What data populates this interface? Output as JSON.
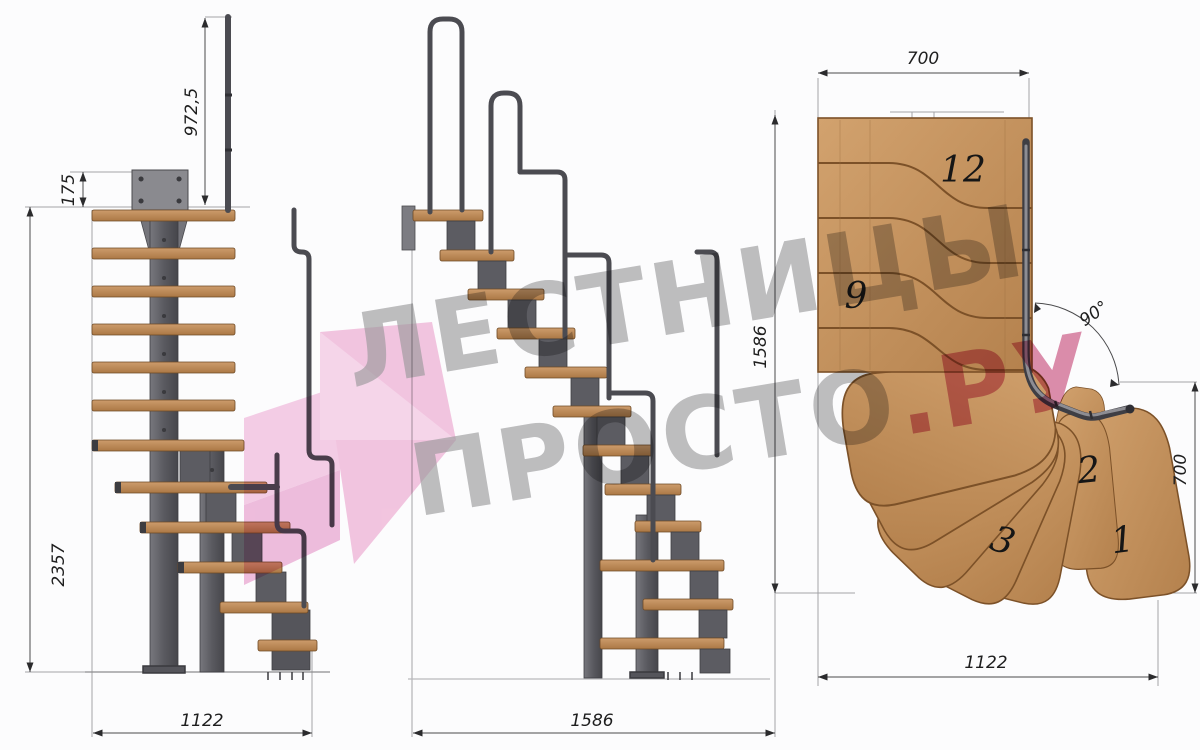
{
  "views": {
    "side_a": {
      "dim_rail_height": "972,5",
      "dim_top_offset": "175",
      "dim_total_height": "2357",
      "dim_width": "1122"
    },
    "side_b": {
      "dim_depth": "1586"
    },
    "plan": {
      "dim_top_width": "700",
      "dim_side_height": "1586",
      "dim_turn_angle": "90°",
      "dim_right_depth": "700",
      "dim_bottom_width": "1122",
      "tread_labels": [
        "12",
        "9",
        "3",
        "2",
        "1"
      ]
    }
  },
  "watermark": {
    "line1": "ЛЕСТНИЦЫ",
    "line2_main": "ПРОСТО",
    "line2_accent": ".РУ",
    "text_color": "#98989a",
    "accent_color": "#c9497a",
    "arrow_color": "#f2badb"
  },
  "colors": {
    "background": "#fcfcfd",
    "wood": "#c08a58",
    "wood_outline": "#7c5128",
    "metal": "#5d5d63",
    "rail": "#47474c",
    "dimension": "#222222"
  }
}
